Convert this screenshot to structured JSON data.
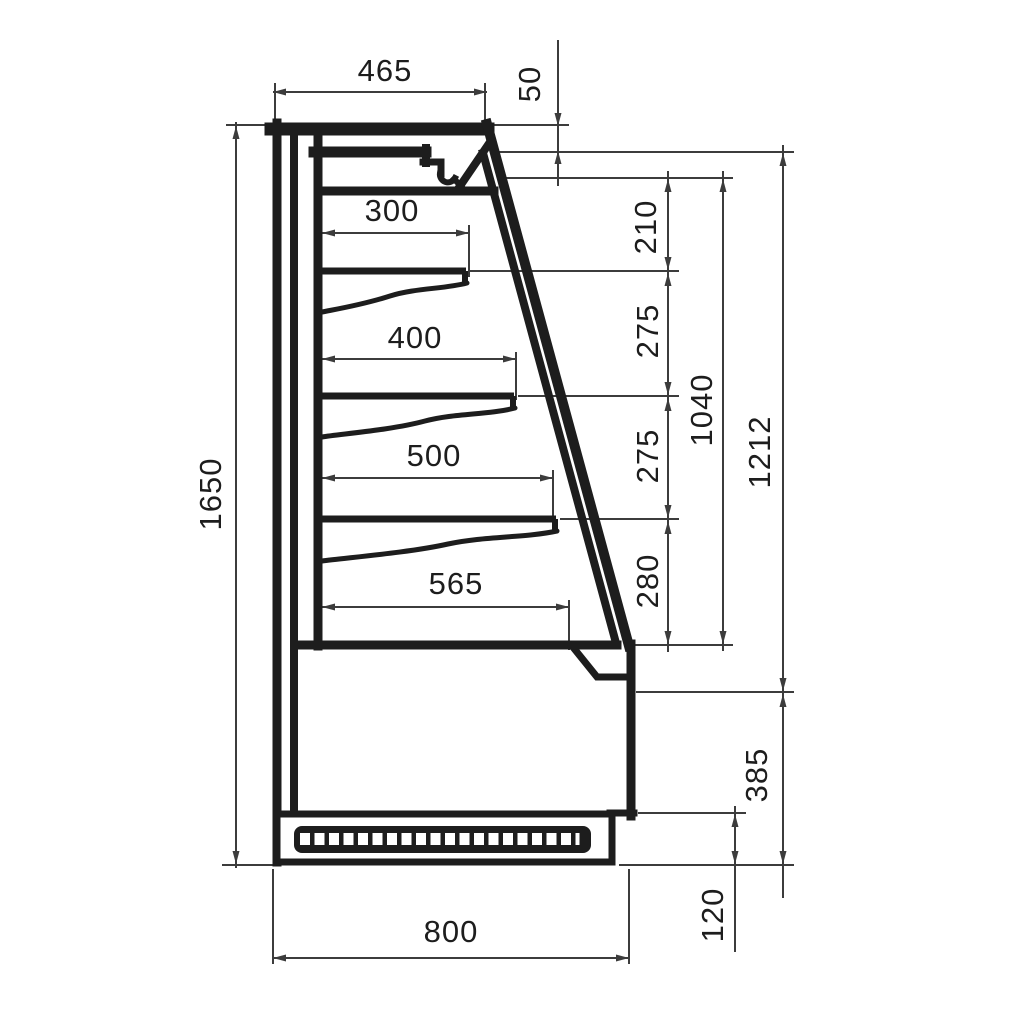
{
  "dims": {
    "top_depth": "465",
    "canopy_front_height": "50",
    "shelf1_depth": "300",
    "shelf2_depth": "400",
    "shelf3_depth": "500",
    "base_shelf_depth": "565",
    "gap_top": "210",
    "gap_upper_mid": "275",
    "gap_lower_mid": "275",
    "gap_bottom": "280",
    "opening_height": "1040",
    "display_height": "1212",
    "overall_height": "1650",
    "base_height": "385",
    "plinth_height": "120",
    "overall_depth": "800"
  }
}
